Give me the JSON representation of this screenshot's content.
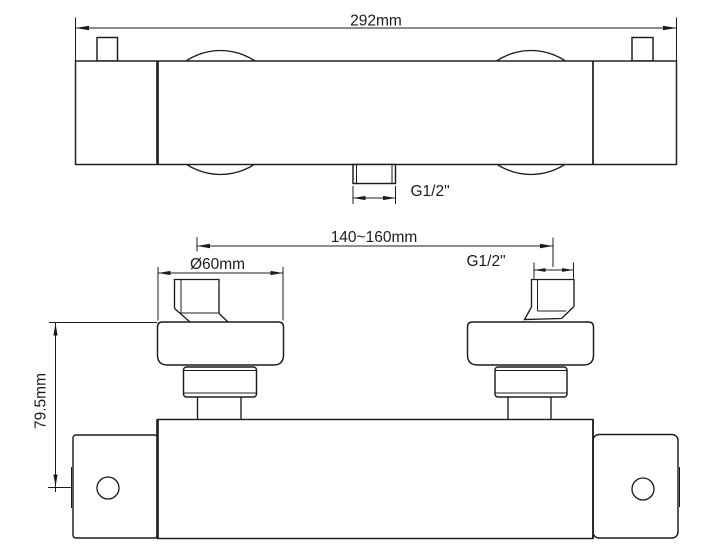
{
  "drawing": {
    "subject": "shower mixer valve technical drawing",
    "background_color": "#ffffff",
    "line_color": "#1c1c1c",
    "views": [
      {
        "id": "top-view",
        "dimension_labels": [
          "292mm",
          "G1/2\""
        ]
      },
      {
        "id": "front-view",
        "dimension_labels": [
          "140~160mm",
          "Ø60mm",
          "G1/2\"",
          "79.5mm"
        ]
      }
    ]
  },
  "labels": {
    "overall_width": "292mm",
    "outlet_thread": "G1/2\"",
    "inlet_centers": "140~160mm",
    "escutcheon_diameter": "Ø60mm",
    "inlet_thread": "G1/2\"",
    "body_height": "79.5mm"
  }
}
